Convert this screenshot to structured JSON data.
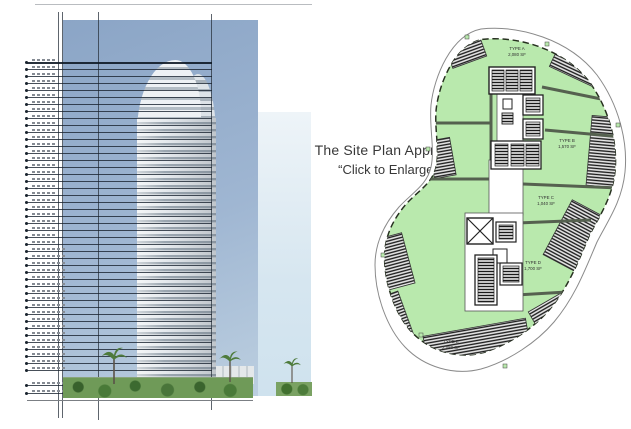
{
  "annotation": {
    "line1": "The Site Plan Approval",
    "line2": "“Click to Enlarge”"
  },
  "elevation": {
    "description": "high-rise tower elevation rendering with floor level datum lines",
    "floor_line_count": 45,
    "colors": {
      "sky_top": "#8ba5c6",
      "sky_bottom": "#bccfe0",
      "tower_light": "#e6eaee",
      "tower_dark": "#9ba6b0",
      "vegetation": "#6f9a58",
      "datum_line": "#19232f"
    }
  },
  "site_plan": {
    "description": "typical floor site plan with unit areas shaded green",
    "units": [
      {
        "type": "TYPE A",
        "area": "2,080 SF"
      },
      {
        "type": "TYPE B",
        "area": "1,570 SF"
      },
      {
        "type": "TYPE C",
        "area": "1,040 SF"
      },
      {
        "type": "TYPE D",
        "area": "1,700 SF"
      },
      {
        "type": "TYPE E",
        "area": "2,080 SF"
      }
    ],
    "colors": {
      "unit_fill": "#b9e9ad",
      "wall": "#55614f",
      "outline": "#26301f",
      "balcony_hatch": "#1a1a1a"
    }
  }
}
